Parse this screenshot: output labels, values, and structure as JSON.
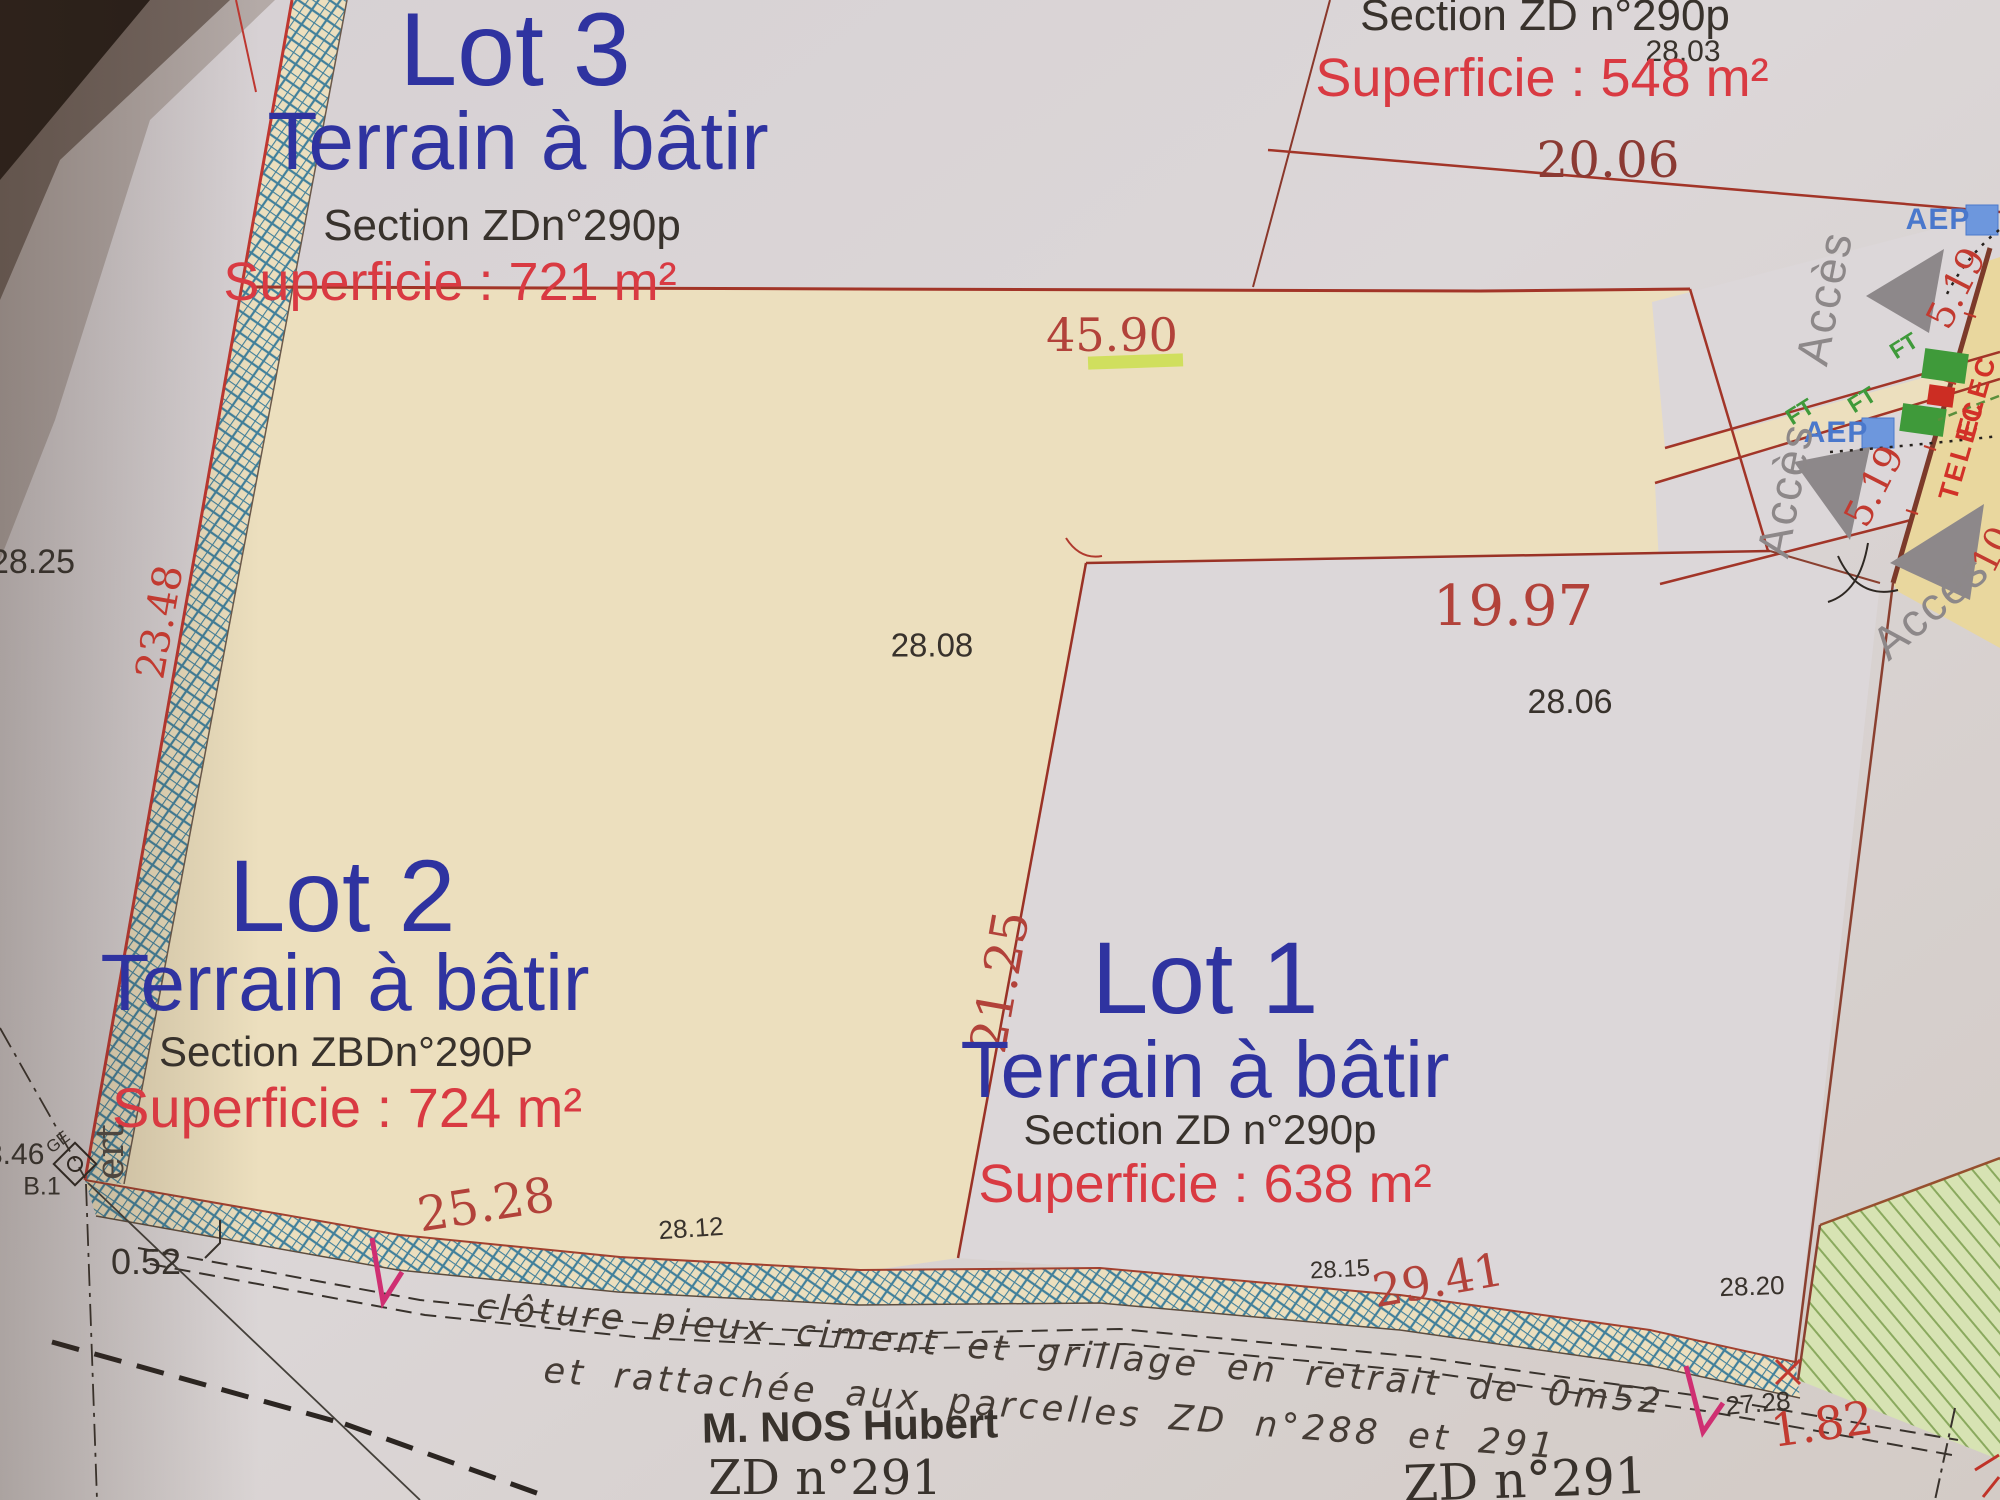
{
  "document": {
    "kind": "Plan de division - photo de plan cadastral"
  },
  "lots": {
    "lot3": {
      "title": "Lot 3",
      "terrain": "Terrain à bâtir",
      "section": "Section ZDn°290p",
      "superficie": "Superficie : 721 m²"
    },
    "lot2": {
      "title": "Lot 2",
      "terrain": "Terrain à bâtir",
      "section": "Section ZBDn°290P",
      "superficie": "Superficie : 724 m²"
    },
    "lot1": {
      "title": "Lot 1",
      "terrain": "Terrain à bâtir",
      "section": "Section ZD n°290p",
      "superficie": "Superficie : 638 m²"
    },
    "remainder": {
      "section": "Section ZD n°290p",
      "superficie": "Superficie : 548 m²"
    }
  },
  "dims": {
    "d45_90": "45.90",
    "d28_25": "28.25",
    "d23_48": "23.48",
    "d28_08": "28.08",
    "d19_97": "19.97",
    "d28_06": "28.06",
    "d21_25": "21.25",
    "d28_03": "28.03",
    "d20_06": "20.06",
    "d25_28": "25.28",
    "d28_12": "28.12",
    "d28_15": "28.15",
    "d29_41": "29.41",
    "d28_20": "28.20",
    "d27_28": "27.28",
    "d1_82": "1.82",
    "d0_52": "0.52",
    "d3_46": "3.46",
    "d5_19_a": "5.19",
    "d5_19_b": "5.19",
    "d10": "10."
  },
  "labels": {
    "acces": "Accès",
    "aep": "AEP",
    "ft": "FT",
    "elec": "ELEC",
    "telec": "TELEC",
    "borne": "B.1",
    "ge": "GE",
    "edge_text": "ert",
    "cloture_line1": "clôture pieux ciment et grillage en retrait de 0m52",
    "cloture_line2": "et rattachée aux parcelles ZD n°288 et 291",
    "owner": "M. NOS Hubert",
    "parcel_bottom": "ZD n°291",
    "parcel_right": "ZD n°291"
  },
  "colors": {
    "lot_title_blue": "#2f33a0",
    "superficie_red": "#d93a42",
    "dim_red": "#b2423a",
    "line_red": "#a23528",
    "hatch_blue": "#41809b",
    "cream": "#ecdfbe",
    "aep_blue": "#4a78cc",
    "ft_green": "#3f9a3a",
    "elec_red": "#d23128",
    "acces_gray": "#8d8889",
    "magenta": "#cf2f72",
    "green_area": "#d7e3b3"
  }
}
